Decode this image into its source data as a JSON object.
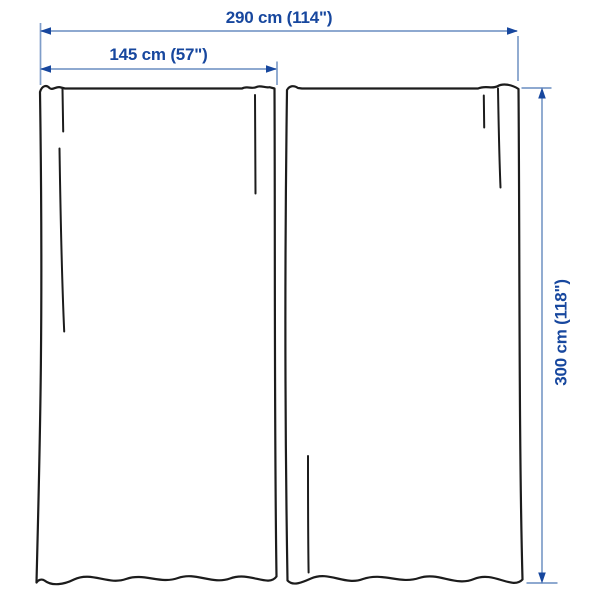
{
  "figure": {
    "type": "product-dimension-diagram",
    "subject": "curtain pair, 2 panels"
  },
  "labels": {
    "total_width": "290 cm (114\")",
    "panel_width": "145 cm (57\")",
    "panel_height": "300 cm (118\")"
  },
  "colors": {
    "accent": "#17479E",
    "dimline": "#7E9DC9",
    "outline": "#1C1C1C",
    "background": "#FFFFFF"
  }
}
